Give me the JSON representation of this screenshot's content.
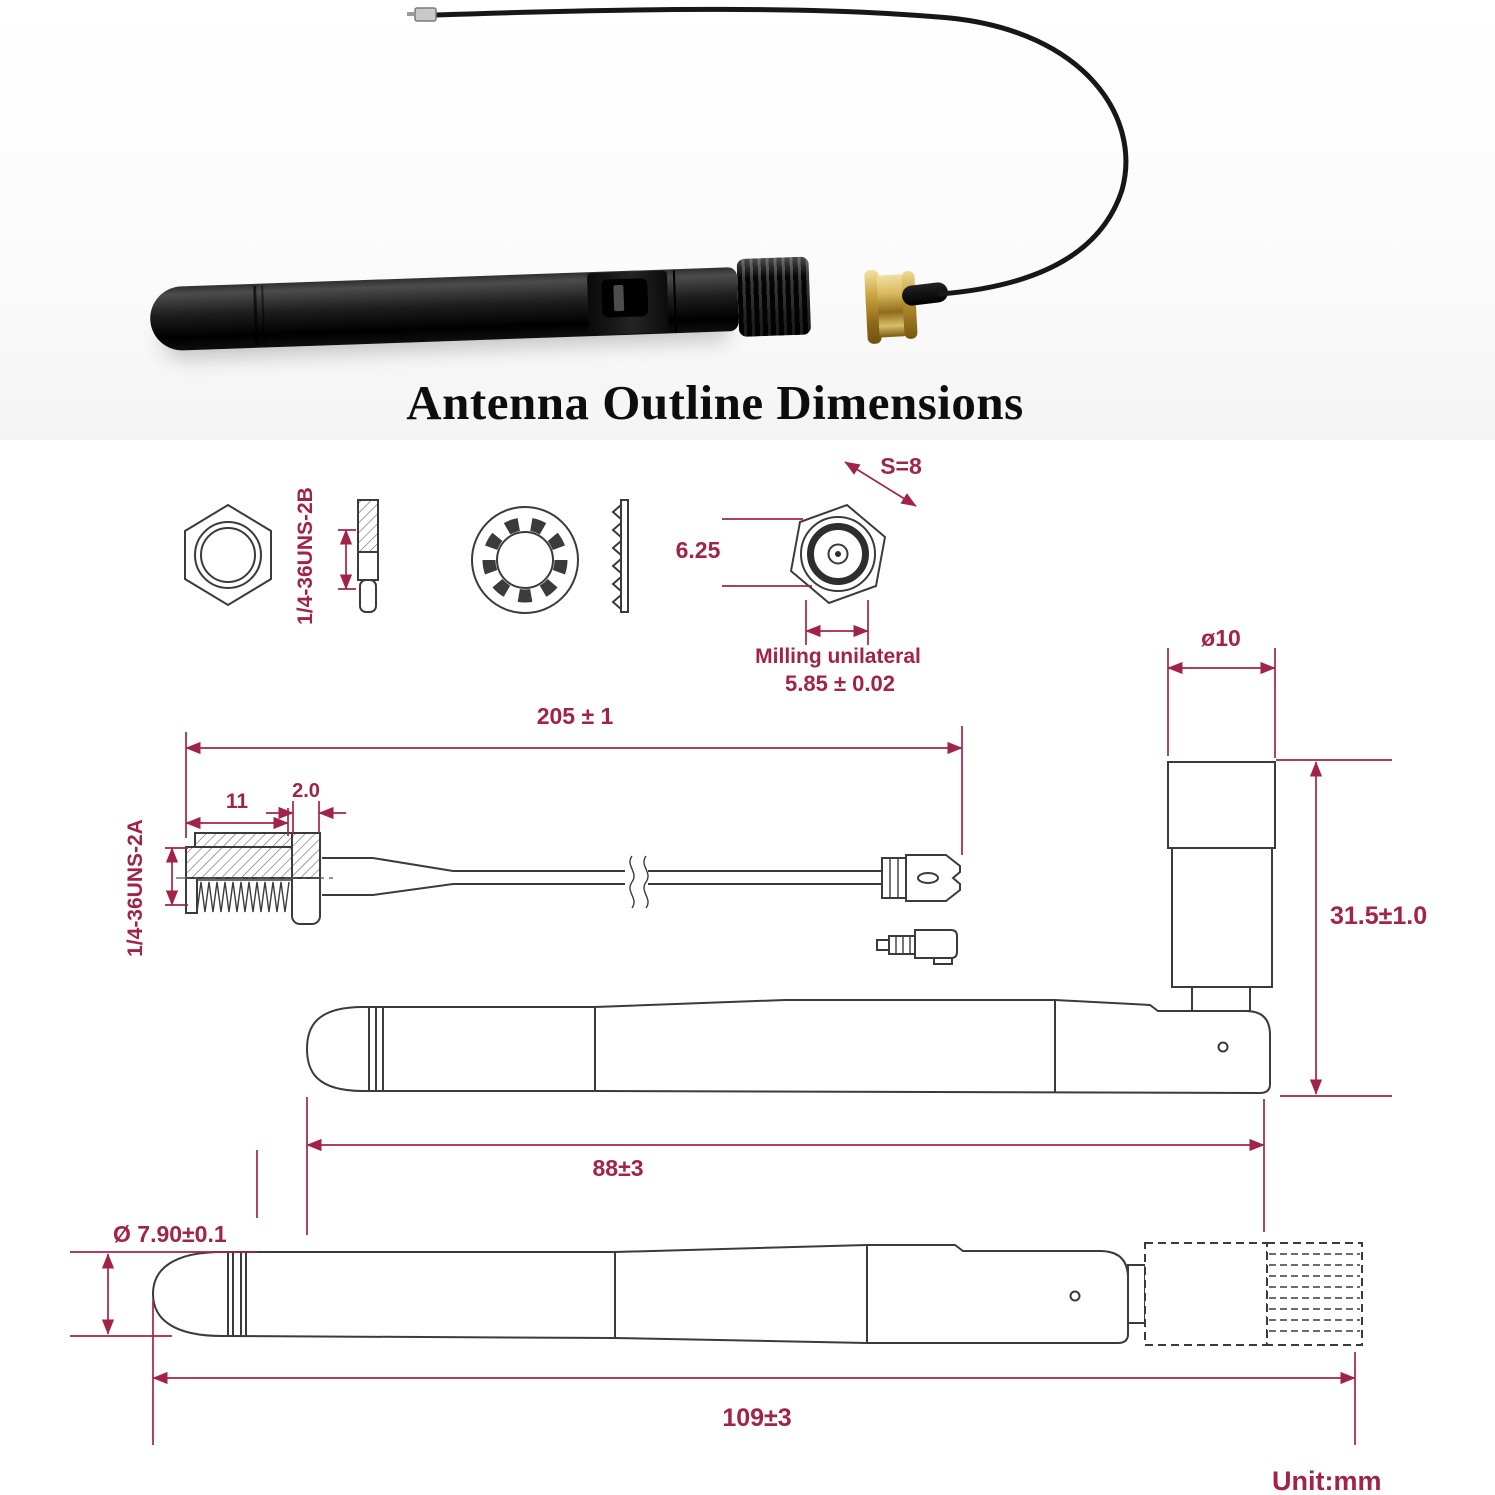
{
  "title": "Antenna Outline Dimensions",
  "colors": {
    "dimension": "#A32347",
    "outline": "#3B3B3B",
    "gold": "#C9A24A",
    "antenna_black": "#141414"
  },
  "drawing": {
    "nut_side": {
      "thread_spec": "1/4-36UNS-2B"
    },
    "sma_face": {
      "across_flats": "S=8",
      "diameter": "6.25",
      "milling_line1": "Milling unilateral",
      "milling_line2": "5.85 ± 0.02"
    },
    "pigtail": {
      "overall_length": "205 ± 1",
      "thread_length": "11",
      "flange_thickness": "2.0",
      "thread_spec": "1/4-36UNS-2A"
    },
    "folded_antenna": {
      "connector_diameter": "ø10",
      "connector_height": "31.5±1.0",
      "folded_length": "88±3"
    },
    "straight_antenna": {
      "diameter": "Ø 7.90±0.1",
      "length": "109±3"
    },
    "unit": "Unit:mm"
  }
}
